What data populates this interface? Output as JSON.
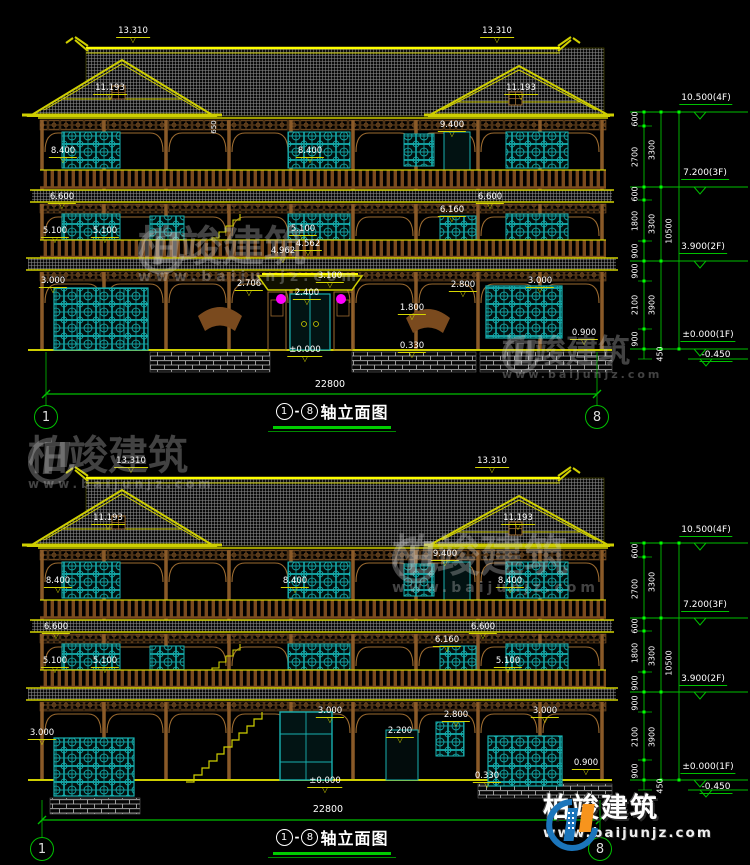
{
  "colors": {
    "background": "#000000",
    "line_yellow": "#cfcf00",
    "bright_yellow": "#ffff00",
    "dim_green": "#00c000",
    "teal_window": "#18b0b0",
    "brown_wood": "#9c6b30",
    "roof_gray": "#8f8f8f",
    "lantern_magenta": "#ff00ff",
    "label_white": "#ffffff",
    "logo_blue": "#1b75bb",
    "logo_orange": "#f7941d"
  },
  "symbols": {
    "triangle": "▽",
    "dash": "-"
  },
  "brand": {
    "name": "柏竣建筑",
    "url": "www.baijunjz.com"
  },
  "drawings": {
    "top": {
      "title": {
        "from": "1",
        "to": "8",
        "label": "轴立面图"
      },
      "axis_left": "1",
      "axis_right": "8",
      "total_width_dim": "22800",
      "floor_markers": [
        "10.500(4F)",
        "7.200(3F)",
        "3.900(2F)",
        "±0.000(1F)",
        "-0.450"
      ],
      "labels": [
        {
          "text": "13.310",
          "x": 133,
          "y": 27,
          "kind": "elev"
        },
        {
          "text": "13.310",
          "x": 497,
          "y": 27,
          "kind": "elev"
        },
        {
          "text": "11.193",
          "x": 110,
          "y": 84,
          "kind": "elev"
        },
        {
          "text": "11.193",
          "x": 521,
          "y": 84,
          "kind": "elev"
        },
        {
          "text": "9.400",
          "x": 452,
          "y": 121,
          "kind": "elev"
        },
        {
          "text": "650",
          "x": 215,
          "y": 127,
          "kind": "vert"
        },
        {
          "text": "8.400",
          "x": 63,
          "y": 147,
          "kind": "elev"
        },
        {
          "text": "8.400",
          "x": 310,
          "y": 147,
          "kind": "elev"
        },
        {
          "text": "6.600",
          "x": 62,
          "y": 193,
          "kind": "elev"
        },
        {
          "text": "6.600",
          "x": 490,
          "y": 193,
          "kind": "elev"
        },
        {
          "text": "6.160",
          "x": 452,
          "y": 206,
          "kind": "elev"
        },
        {
          "text": "5.100",
          "x": 55,
          "y": 227,
          "kind": "elev"
        },
        {
          "text": "5.100",
          "x": 105,
          "y": 227,
          "kind": "elev"
        },
        {
          "text": "5.100",
          "x": 303,
          "y": 225,
          "kind": "elev"
        },
        {
          "text": "4.562",
          "x": 308,
          "y": 240,
          "kind": "elev"
        },
        {
          "text": "4.962",
          "x": 283,
          "y": 247,
          "kind": "elev"
        },
        {
          "text": "3.100",
          "x": 330,
          "y": 272,
          "kind": "elev"
        },
        {
          "text": "3.000",
          "x": 53,
          "y": 277,
          "kind": "elev"
        },
        {
          "text": "3.000",
          "x": 540,
          "y": 277,
          "kind": "elev"
        },
        {
          "text": "2.800",
          "x": 463,
          "y": 281,
          "kind": "elev"
        },
        {
          "text": "2.706",
          "x": 249,
          "y": 280,
          "kind": "elev"
        },
        {
          "text": "2.400",
          "x": 307,
          "y": 289,
          "kind": "elev"
        },
        {
          "text": "1.800",
          "x": 412,
          "y": 304,
          "kind": "elev"
        },
        {
          "text": "0.900",
          "x": 584,
          "y": 329,
          "kind": "elev"
        },
        {
          "text": "0.330",
          "x": 412,
          "y": 342,
          "kind": "elev"
        },
        {
          "text": "±0.000",
          "x": 305,
          "y": 346,
          "kind": "elev"
        },
        {
          "text": "22800",
          "x": 330,
          "y": 380,
          "kind": "plain"
        },
        {
          "text": "10.500(4F)",
          "x": 706,
          "y": 94,
          "kind": "gmark"
        },
        {
          "text": "7.200(3F)",
          "x": 705,
          "y": 169,
          "kind": "gmark"
        },
        {
          "text": "3.900(2F)",
          "x": 703,
          "y": 243,
          "kind": "gmark"
        },
        {
          "text": "±0.000(1F)",
          "x": 708,
          "y": 331,
          "kind": "gmark"
        },
        {
          "text": "-0.450",
          "x": 716,
          "y": 351,
          "kind": "gmark"
        },
        {
          "text": "600",
          "x": 636,
          "y": 119,
          "kind": "vdim"
        },
        {
          "text": "2700",
          "x": 636,
          "y": 157,
          "kind": "vdim"
        },
        {
          "text": "600",
          "x": 636,
          "y": 194,
          "kind": "vdim"
        },
        {
          "text": "1800",
          "x": 636,
          "y": 221,
          "kind": "vdim"
        },
        {
          "text": "900",
          "x": 636,
          "y": 251,
          "kind": "vdim"
        },
        {
          "text": "900",
          "x": 636,
          "y": 271,
          "kind": "vdim"
        },
        {
          "text": "2100",
          "x": 636,
          "y": 305,
          "kind": "vdim"
        },
        {
          "text": "900",
          "x": 636,
          "y": 339,
          "kind": "vdim"
        },
        {
          "text": "3300",
          "x": 653,
          "y": 150,
          "kind": "vdim"
        },
        {
          "text": "3300",
          "x": 653,
          "y": 224,
          "kind": "vdim"
        },
        {
          "text": "3900",
          "x": 653,
          "y": 305,
          "kind": "vdim"
        },
        {
          "text": "10500",
          "x": 670,
          "y": 231,
          "kind": "vdim"
        },
        {
          "text": "450",
          "x": 661,
          "y": 354,
          "kind": "vdim"
        }
      ]
    },
    "bottom": {
      "title": {
        "from": "1",
        "to": "8",
        "label": "轴立面图"
      },
      "axis_left": "1",
      "axis_right": "8",
      "total_width_dim": "22800",
      "floor_markers": [
        "10.500(4F)",
        "7.200(3F)",
        "3.900(2F)",
        "±0.000(1F)",
        "-0.450"
      ],
      "labels": [
        {
          "text": "13.310",
          "x": 131,
          "y": 457,
          "kind": "elev"
        },
        {
          "text": "13.310",
          "x": 492,
          "y": 457,
          "kind": "elev"
        },
        {
          "text": "11.193",
          "x": 108,
          "y": 514,
          "kind": "elev"
        },
        {
          "text": "11.193",
          "x": 518,
          "y": 514,
          "kind": "elev"
        },
        {
          "text": "9.400",
          "x": 445,
          "y": 550,
          "kind": "elev"
        },
        {
          "text": "8.400",
          "x": 58,
          "y": 577,
          "kind": "elev"
        },
        {
          "text": "8.400",
          "x": 295,
          "y": 577,
          "kind": "elev"
        },
        {
          "text": "8.400",
          "x": 510,
          "y": 577,
          "kind": "elev"
        },
        {
          "text": "6.600",
          "x": 56,
          "y": 623,
          "kind": "elev"
        },
        {
          "text": "6.600",
          "x": 483,
          "y": 623,
          "kind": "elev"
        },
        {
          "text": "6.160",
          "x": 447,
          "y": 636,
          "kind": "elev"
        },
        {
          "text": "5.100",
          "x": 55,
          "y": 657,
          "kind": "elev"
        },
        {
          "text": "5.100",
          "x": 105,
          "y": 657,
          "kind": "elev"
        },
        {
          "text": "5.100",
          "x": 508,
          "y": 657,
          "kind": "elev"
        },
        {
          "text": "3.000",
          "x": 42,
          "y": 729,
          "kind": "elev"
        },
        {
          "text": "3.000",
          "x": 330,
          "y": 707,
          "kind": "elev"
        },
        {
          "text": "3.000",
          "x": 545,
          "y": 707,
          "kind": "elev"
        },
        {
          "text": "2.800",
          "x": 456,
          "y": 711,
          "kind": "elev"
        },
        {
          "text": "2.200",
          "x": 400,
          "y": 727,
          "kind": "elev"
        },
        {
          "text": "0.900",
          "x": 586,
          "y": 759,
          "kind": "elev"
        },
        {
          "text": "0.330",
          "x": 487,
          "y": 772,
          "kind": "elev"
        },
        {
          "text": "±0.000",
          "x": 325,
          "y": 777,
          "kind": "elev"
        },
        {
          "text": "22800",
          "x": 328,
          "y": 805,
          "kind": "plain"
        },
        {
          "text": "10.500(4F)",
          "x": 706,
          "y": 526,
          "kind": "gmark"
        },
        {
          "text": "7.200(3F)",
          "x": 705,
          "y": 601,
          "kind": "gmark"
        },
        {
          "text": "3.900(2F)",
          "x": 703,
          "y": 675,
          "kind": "gmark"
        },
        {
          "text": "±0.000(1F)",
          "x": 708,
          "y": 763,
          "kind": "gmark"
        },
        {
          "text": "-0.450",
          "x": 716,
          "y": 783,
          "kind": "gmark"
        },
        {
          "text": "600",
          "x": 636,
          "y": 551,
          "kind": "vdim"
        },
        {
          "text": "2700",
          "x": 636,
          "y": 589,
          "kind": "vdim"
        },
        {
          "text": "600",
          "x": 636,
          "y": 626,
          "kind": "vdim"
        },
        {
          "text": "1800",
          "x": 636,
          "y": 653,
          "kind": "vdim"
        },
        {
          "text": "900",
          "x": 636,
          "y": 683,
          "kind": "vdim"
        },
        {
          "text": "900",
          "x": 636,
          "y": 703,
          "kind": "vdim"
        },
        {
          "text": "2100",
          "x": 636,
          "y": 737,
          "kind": "vdim"
        },
        {
          "text": "900",
          "x": 636,
          "y": 771,
          "kind": "vdim"
        },
        {
          "text": "3300",
          "x": 653,
          "y": 582,
          "kind": "vdim"
        },
        {
          "text": "3300",
          "x": 653,
          "y": 656,
          "kind": "vdim"
        },
        {
          "text": "3900",
          "x": 653,
          "y": 737,
          "kind": "vdim"
        },
        {
          "text": "10500",
          "x": 670,
          "y": 663,
          "kind": "vdim"
        },
        {
          "text": "450",
          "x": 661,
          "y": 786,
          "kind": "vdim"
        }
      ]
    }
  }
}
